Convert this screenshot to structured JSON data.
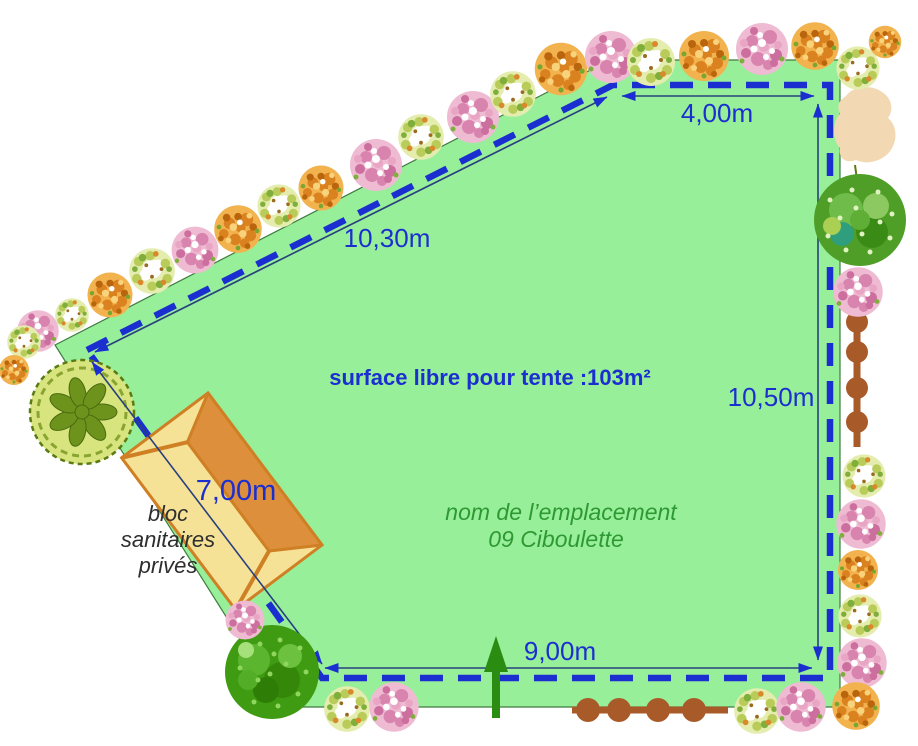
{
  "plan": {
    "area_label": "surface libre pour tente :103m²",
    "site_name_line1": "nom de l’emplacement",
    "site_name_line2": "09 Ciboulette",
    "building_label_lines": [
      "bloc",
      "sanitaires",
      "privés"
    ],
    "dimensions": {
      "top": "4,00m",
      "diagonal": "10,30m",
      "right": "10,50m",
      "bottom": "9,00m",
      "building_side": "7,00m"
    }
  },
  "colors": {
    "plot-green": "#98ef9a",
    "boundary-blue": "#1b2fd0",
    "measure-navy": "#27407e",
    "dim-text-blue": "#1b2fd0",
    "site-name-green": "#2e9933",
    "building-pale": "#f6e296",
    "building-roof": "#dd8f3c",
    "building-trim": "#cf7f24",
    "path-brown": "#a85a28",
    "arrow-green": "#2b8c12"
  }
}
